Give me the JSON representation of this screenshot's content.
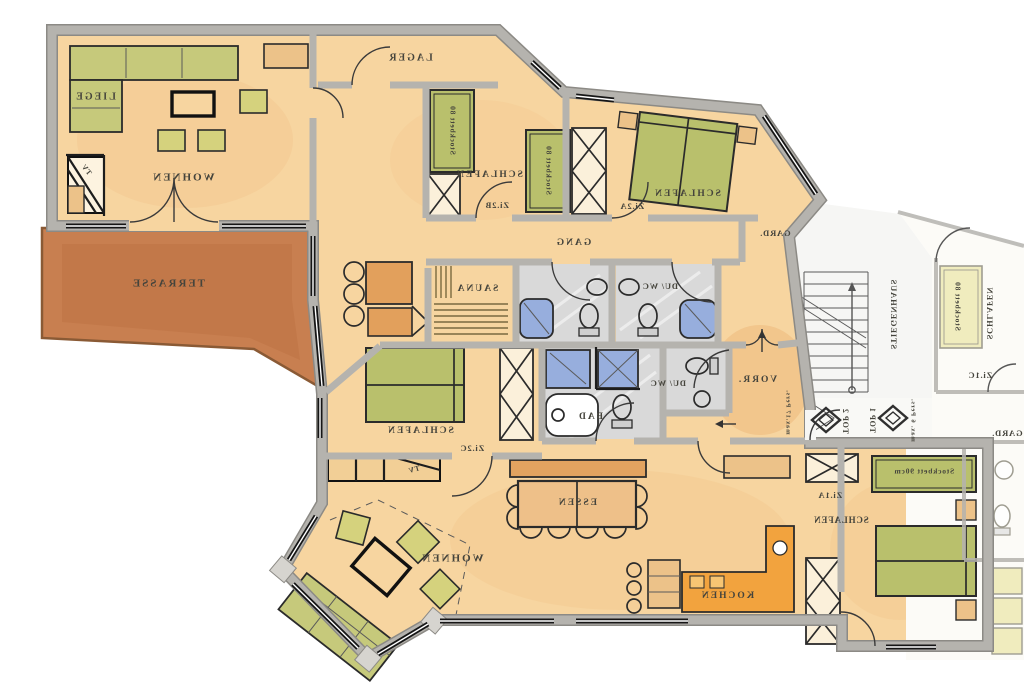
{
  "meta": {
    "description": "Mirrored scanned apartment floor plan (TOP 2 with neighbouring TOP 1 / stairwell)",
    "mirrored_text": true
  },
  "colors": {
    "floor": "#f7d5a0",
    "floorDeep": "#f0c389",
    "terrace": "#c87f50",
    "terraceEdge": "#8a5a35",
    "wall": "#b5b3ae",
    "wallEdge": "#8c8a85",
    "bath": "#d9d9d9",
    "bathStreak": "#efefef",
    "shower": "#97aedd",
    "bedGreen": "#b9c06c",
    "bedGreenLight": "#cdd089",
    "tan": "#ecc289",
    "tanDeep": "#e2a360",
    "kitchenOrange": "#f2a33e",
    "stairFloor": "#f6f6f4",
    "neighborFloor": "#fcfbf7",
    "neighborBed": "#eeeab5",
    "ink": "#45443c"
  },
  "labels": [
    {
      "id": "liege",
      "text": "LIEGE",
      "x": 95,
      "y": 97,
      "s": 10,
      "r": 0
    },
    {
      "id": "wohnen-upper",
      "text": "WOHNEN",
      "x": 183,
      "y": 178,
      "s": 11,
      "r": 0
    },
    {
      "id": "terrasse",
      "text": "TERRASSE",
      "x": 168,
      "y": 284,
      "s": 11,
      "r": 0
    },
    {
      "id": "lager",
      "text": "LAGER",
      "x": 410,
      "y": 58,
      "s": 10,
      "r": 0
    },
    {
      "id": "schlafen-2b",
      "text": "SCHLAFEN",
      "x": 489,
      "y": 175,
      "s": 9.5,
      "r": 0
    },
    {
      "id": "zi-2b",
      "text": "Zi.2B",
      "x": 497,
      "y": 206,
      "s": 8.5,
      "r": 0
    },
    {
      "id": "stockbett-2b-1",
      "text": "Stockbett 80",
      "x": 452,
      "y": 130,
      "s": 7.5,
      "r": 90
    },
    {
      "id": "stockbett-2b-2",
      "text": "Stockbett 80",
      "x": 548,
      "y": 170,
      "s": 7.5,
      "r": 90
    },
    {
      "id": "schlafen-2a",
      "text": "SCHLAFEN",
      "x": 687,
      "y": 194,
      "s": 9.5,
      "r": 0
    },
    {
      "id": "zi-2a",
      "text": "Zi.2A",
      "x": 632,
      "y": 207,
      "s": 8.5,
      "r": 0
    },
    {
      "id": "gang",
      "text": "GANG",
      "x": 573,
      "y": 243,
      "s": 9.5,
      "r": 0
    },
    {
      "id": "gard-1",
      "text": "GARD.",
      "x": 775,
      "y": 234,
      "s": 8.5,
      "r": 0
    },
    {
      "id": "sauna",
      "text": "SAUNA",
      "x": 477,
      "y": 289,
      "s": 9.5,
      "r": 0
    },
    {
      "id": "duwc-1",
      "text": "DU/ WC",
      "x": 660,
      "y": 287,
      "s": 8.5,
      "r": 0
    },
    {
      "id": "duwc-2",
      "text": "DU/ WC",
      "x": 668,
      "y": 384,
      "s": 8.5,
      "r": 0
    },
    {
      "id": "bad",
      "text": "BAD",
      "x": 590,
      "y": 417,
      "s": 9.5,
      "r": 0
    },
    {
      "id": "schlafen-2c",
      "text": "SCHLAFEN",
      "x": 420,
      "y": 431,
      "s": 9.5,
      "r": 0
    },
    {
      "id": "zi-2c",
      "text": "Zi.2C",
      "x": 472,
      "y": 449,
      "s": 8.5,
      "r": 0
    },
    {
      "id": "tv-upper",
      "text": "TV",
      "x": 86,
      "y": 170,
      "s": 7.5,
      "r": 50
    },
    {
      "id": "tv-lower",
      "text": "TV",
      "x": 414,
      "y": 470,
      "s": 7.5,
      "r": -15
    },
    {
      "id": "wohnen-lower",
      "text": "WOHNEN",
      "x": 452,
      "y": 559,
      "s": 11,
      "r": 0
    },
    {
      "id": "essen",
      "text": "ESSEN",
      "x": 577,
      "y": 503,
      "s": 9.5,
      "r": 0
    },
    {
      "id": "kochen",
      "text": "KOCHEN",
      "x": 727,
      "y": 596,
      "s": 9.5,
      "r": 0
    },
    {
      "id": "vorr",
      "text": "VORR.",
      "x": 757,
      "y": 380,
      "s": 9.5,
      "r": 0
    },
    {
      "id": "max17-pers",
      "text": "max.17 Pers.",
      "x": 788,
      "y": 412,
      "s": 6.5,
      "r": 90
    },
    {
      "id": "zi-1a",
      "text": "Zi.1A",
      "x": 830,
      "y": 496,
      "s": 8.5,
      "r": 0
    },
    {
      "id": "schlafen-1a",
      "text": "SCHLAFEN",
      "x": 841,
      "y": 521,
      "s": 9,
      "r": 0
    },
    {
      "id": "stockbett-1a",
      "text": "Stockbett 90cm",
      "x": 924,
      "y": 472,
      "s": 7.5,
      "r": 0
    },
    {
      "id": "stiegenhaus",
      "text": "STIEGENHAUS",
      "x": 893,
      "y": 314,
      "s": 8.5,
      "r": 90
    },
    {
      "id": "top-2",
      "text": "TOP 2",
      "x": 845,
      "y": 421,
      "s": 8,
      "r": 90
    },
    {
      "id": "top-1",
      "text": "TOP 1",
      "x": 872,
      "y": 420,
      "s": 8,
      "r": 90
    },
    {
      "id": "max6-pers",
      "text": "max. 6 Pers.",
      "x": 913,
      "y": 420,
      "s": 6.5,
      "r": 90
    },
    {
      "id": "schlafen-1c",
      "text": "SCHLAFEN",
      "x": 989,
      "y": 313,
      "s": 8.5,
      "r": 90
    },
    {
      "id": "stockbett-1c",
      "text": "Stockbett 80",
      "x": 957,
      "y": 306,
      "s": 7.5,
      "r": 90
    },
    {
      "id": "zi-1c",
      "text": "Zi.1C",
      "x": 980,
      "y": 376,
      "s": 8.5,
      "r": 0
    },
    {
      "id": "gard-2",
      "text": "GARD.",
      "x": 1007,
      "y": 434,
      "s": 8.5,
      "r": 0
    }
  ]
}
